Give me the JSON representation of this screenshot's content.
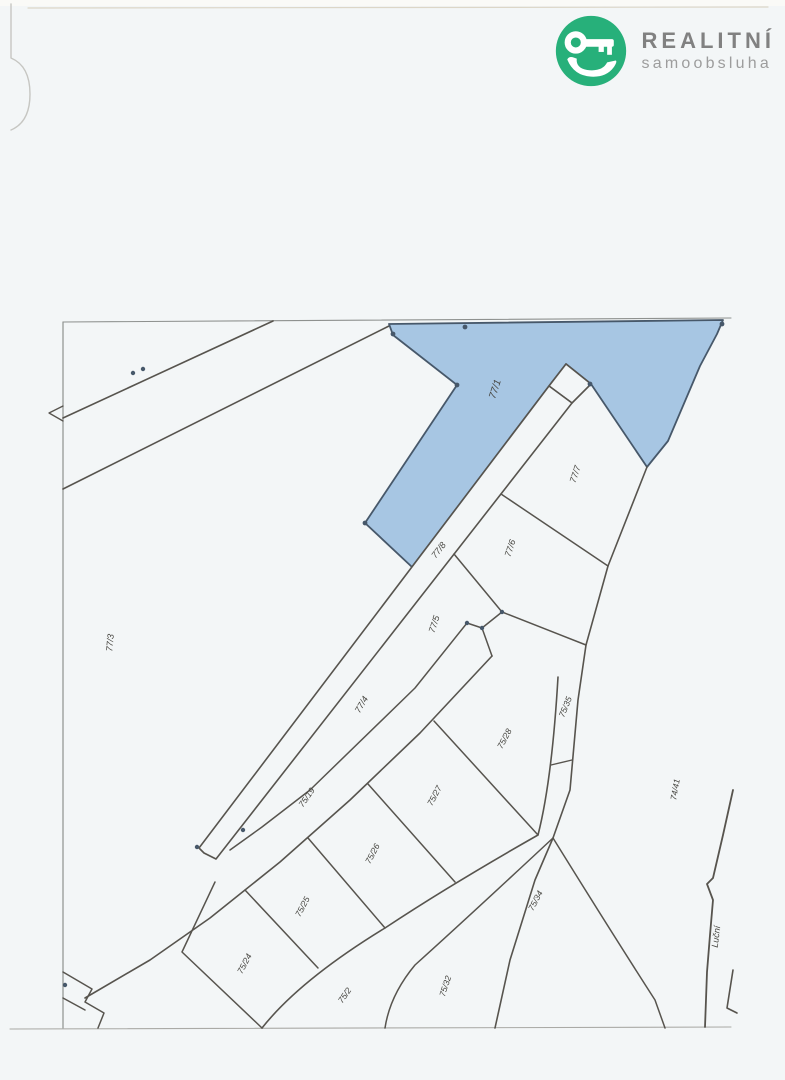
{
  "document": {
    "kind": "scanned cadastral parcel map page",
    "page_background": "#f3f6f7"
  },
  "logo": {
    "icon": "crocodile-hand-key-icon",
    "brand_line1": "REALITNÍ",
    "brand_line2": "samoobsluha",
    "colors": {
      "icon_green": "#27b07a",
      "brand_gray": "#818181",
      "subtitle_gray": "#9d9d9d"
    }
  },
  "map": {
    "type": "cadastral-parcel-map",
    "line_color": "#57544e",
    "highlighted_parcel": {
      "number": "77/1",
      "fill": "#a7c6e3",
      "stroke": "#47586a"
    },
    "street_name": "Luční",
    "parcel_numbers": [
      "77/1",
      "77/3",
      "77/4",
      "77/5",
      "77/6",
      "77/7",
      "77/8",
      "75/2",
      "75/19",
      "75/24",
      "75/25",
      "75/26",
      "75/27",
      "75/28",
      "75/32",
      "75/34",
      "75/35",
      "74/41"
    ],
    "labels": [
      {
        "text": "77/1",
        "x": 498,
        "y": 390,
        "rot": -72,
        "size": 10,
        "highlighted": true
      },
      {
        "text": "77/7",
        "x": 578,
        "y": 475,
        "rot": -72,
        "size": 9
      },
      {
        "text": "77/6",
        "x": 513,
        "y": 549,
        "rot": -72,
        "size": 9
      },
      {
        "text": "77/8",
        "x": 441,
        "y": 552,
        "rot": -52,
        "size": 9
      },
      {
        "text": "77/5",
        "x": 437,
        "y": 625,
        "rot": -72,
        "size": 9
      },
      {
        "text": "77/4",
        "x": 364,
        "y": 706,
        "rot": -60,
        "size": 9
      },
      {
        "text": "77/3",
        "x": 113,
        "y": 643,
        "rot": -85,
        "size": 9
      },
      {
        "text": "75/19",
        "x": 309,
        "y": 799,
        "rot": -55,
        "size": 8.5
      },
      {
        "text": "75/28",
        "x": 507,
        "y": 740,
        "rot": -62,
        "size": 8.5
      },
      {
        "text": "75/35",
        "x": 568,
        "y": 708,
        "rot": -68,
        "size": 8.5
      },
      {
        "text": "75/27",
        "x": 437,
        "y": 797,
        "rot": -62,
        "size": 8.5
      },
      {
        "text": "75/26",
        "x": 375,
        "y": 855,
        "rot": -62,
        "size": 8.5
      },
      {
        "text": "75/25",
        "x": 305,
        "y": 908,
        "rot": -62,
        "size": 8.5
      },
      {
        "text": "75/24",
        "x": 247,
        "y": 965,
        "rot": -62,
        "size": 8.5
      },
      {
        "text": "75/2",
        "x": 347,
        "y": 997,
        "rot": -55,
        "size": 8.5
      },
      {
        "text": "75/32",
        "x": 448,
        "y": 987,
        "rot": -72,
        "size": 8.5
      },
      {
        "text": "75/34",
        "x": 538,
        "y": 902,
        "rot": -62,
        "size": 8.5
      },
      {
        "text": "74/41",
        "x": 678,
        "y": 790,
        "rot": -80,
        "size": 8.5
      },
      {
        "text": "Luční",
        "x": 719,
        "y": 937,
        "rot": -83,
        "size": 9
      }
    ]
  }
}
